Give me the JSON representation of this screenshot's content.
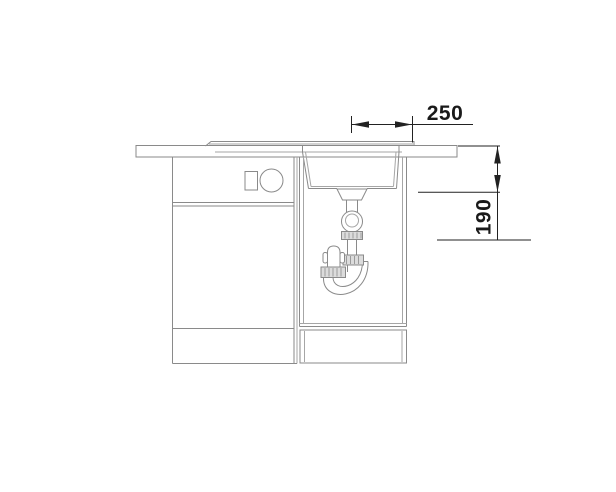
{
  "diagram": {
    "type": "sink-installation-cross-section",
    "dimensions": {
      "drain_offset_label": "250",
      "bowl_depth_label": "190"
    },
    "colors": {
      "background": "#ffffff",
      "drawing_line": "#8a8a8a",
      "dimension_line": "#222222",
      "dimension_text": "#1a1a1a",
      "fitting_fill": "#dcdcdc"
    },
    "components": [
      "worktop",
      "sink-rim",
      "sink-bowl",
      "drain-flange",
      "ball-joint",
      "trap-pipe",
      "u-bend-siphon",
      "compression-nuts",
      "left-base-cabinet",
      "cabinet-control-panel",
      "sink-base-compartment",
      "bottom-drawer"
    ]
  }
}
